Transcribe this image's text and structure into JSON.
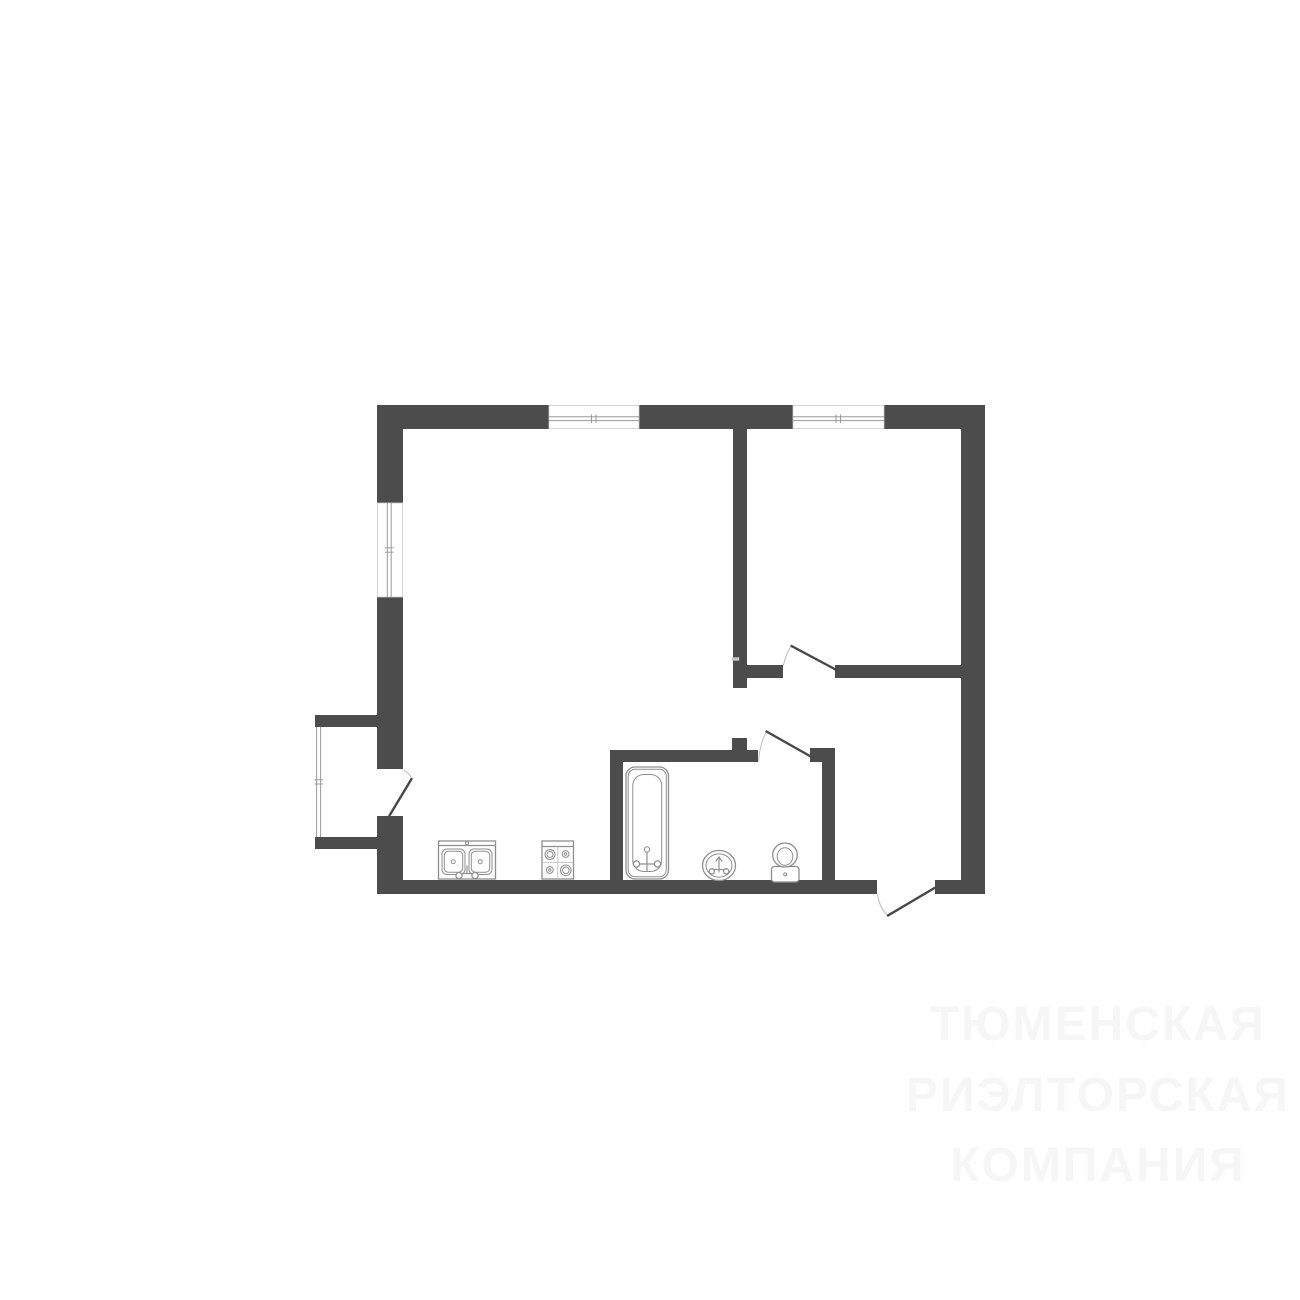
{
  "canvas": {
    "width": 1300,
    "height": 1300,
    "background": "#ffffff"
  },
  "watermark": {
    "line1": "ТЮМЕНСКАЯ",
    "line2": "РИЭЛТОРСКАЯ",
    "line3": "КОМПАНИЯ"
  },
  "colors": {
    "wall": "#4c4c4c",
    "window_stroke": "#9a9a9a",
    "window_frame": "#cccccc",
    "door_leaf": "#474747",
    "door_arc": "#bcbcbc",
    "fixture_stroke": "#8f8f8f",
    "grid_line": "#b9b9b9",
    "watermark": "#f6f6f6"
  },
  "floor_plan": {
    "icons": [
      "kitchen-sink-icon",
      "stove-icon",
      "bathtub-icon",
      "bathroom-sink-icon",
      "toilet-icon",
      "window-icon",
      "door-icon"
    ],
    "window_count": 4,
    "door_count": 4
  }
}
